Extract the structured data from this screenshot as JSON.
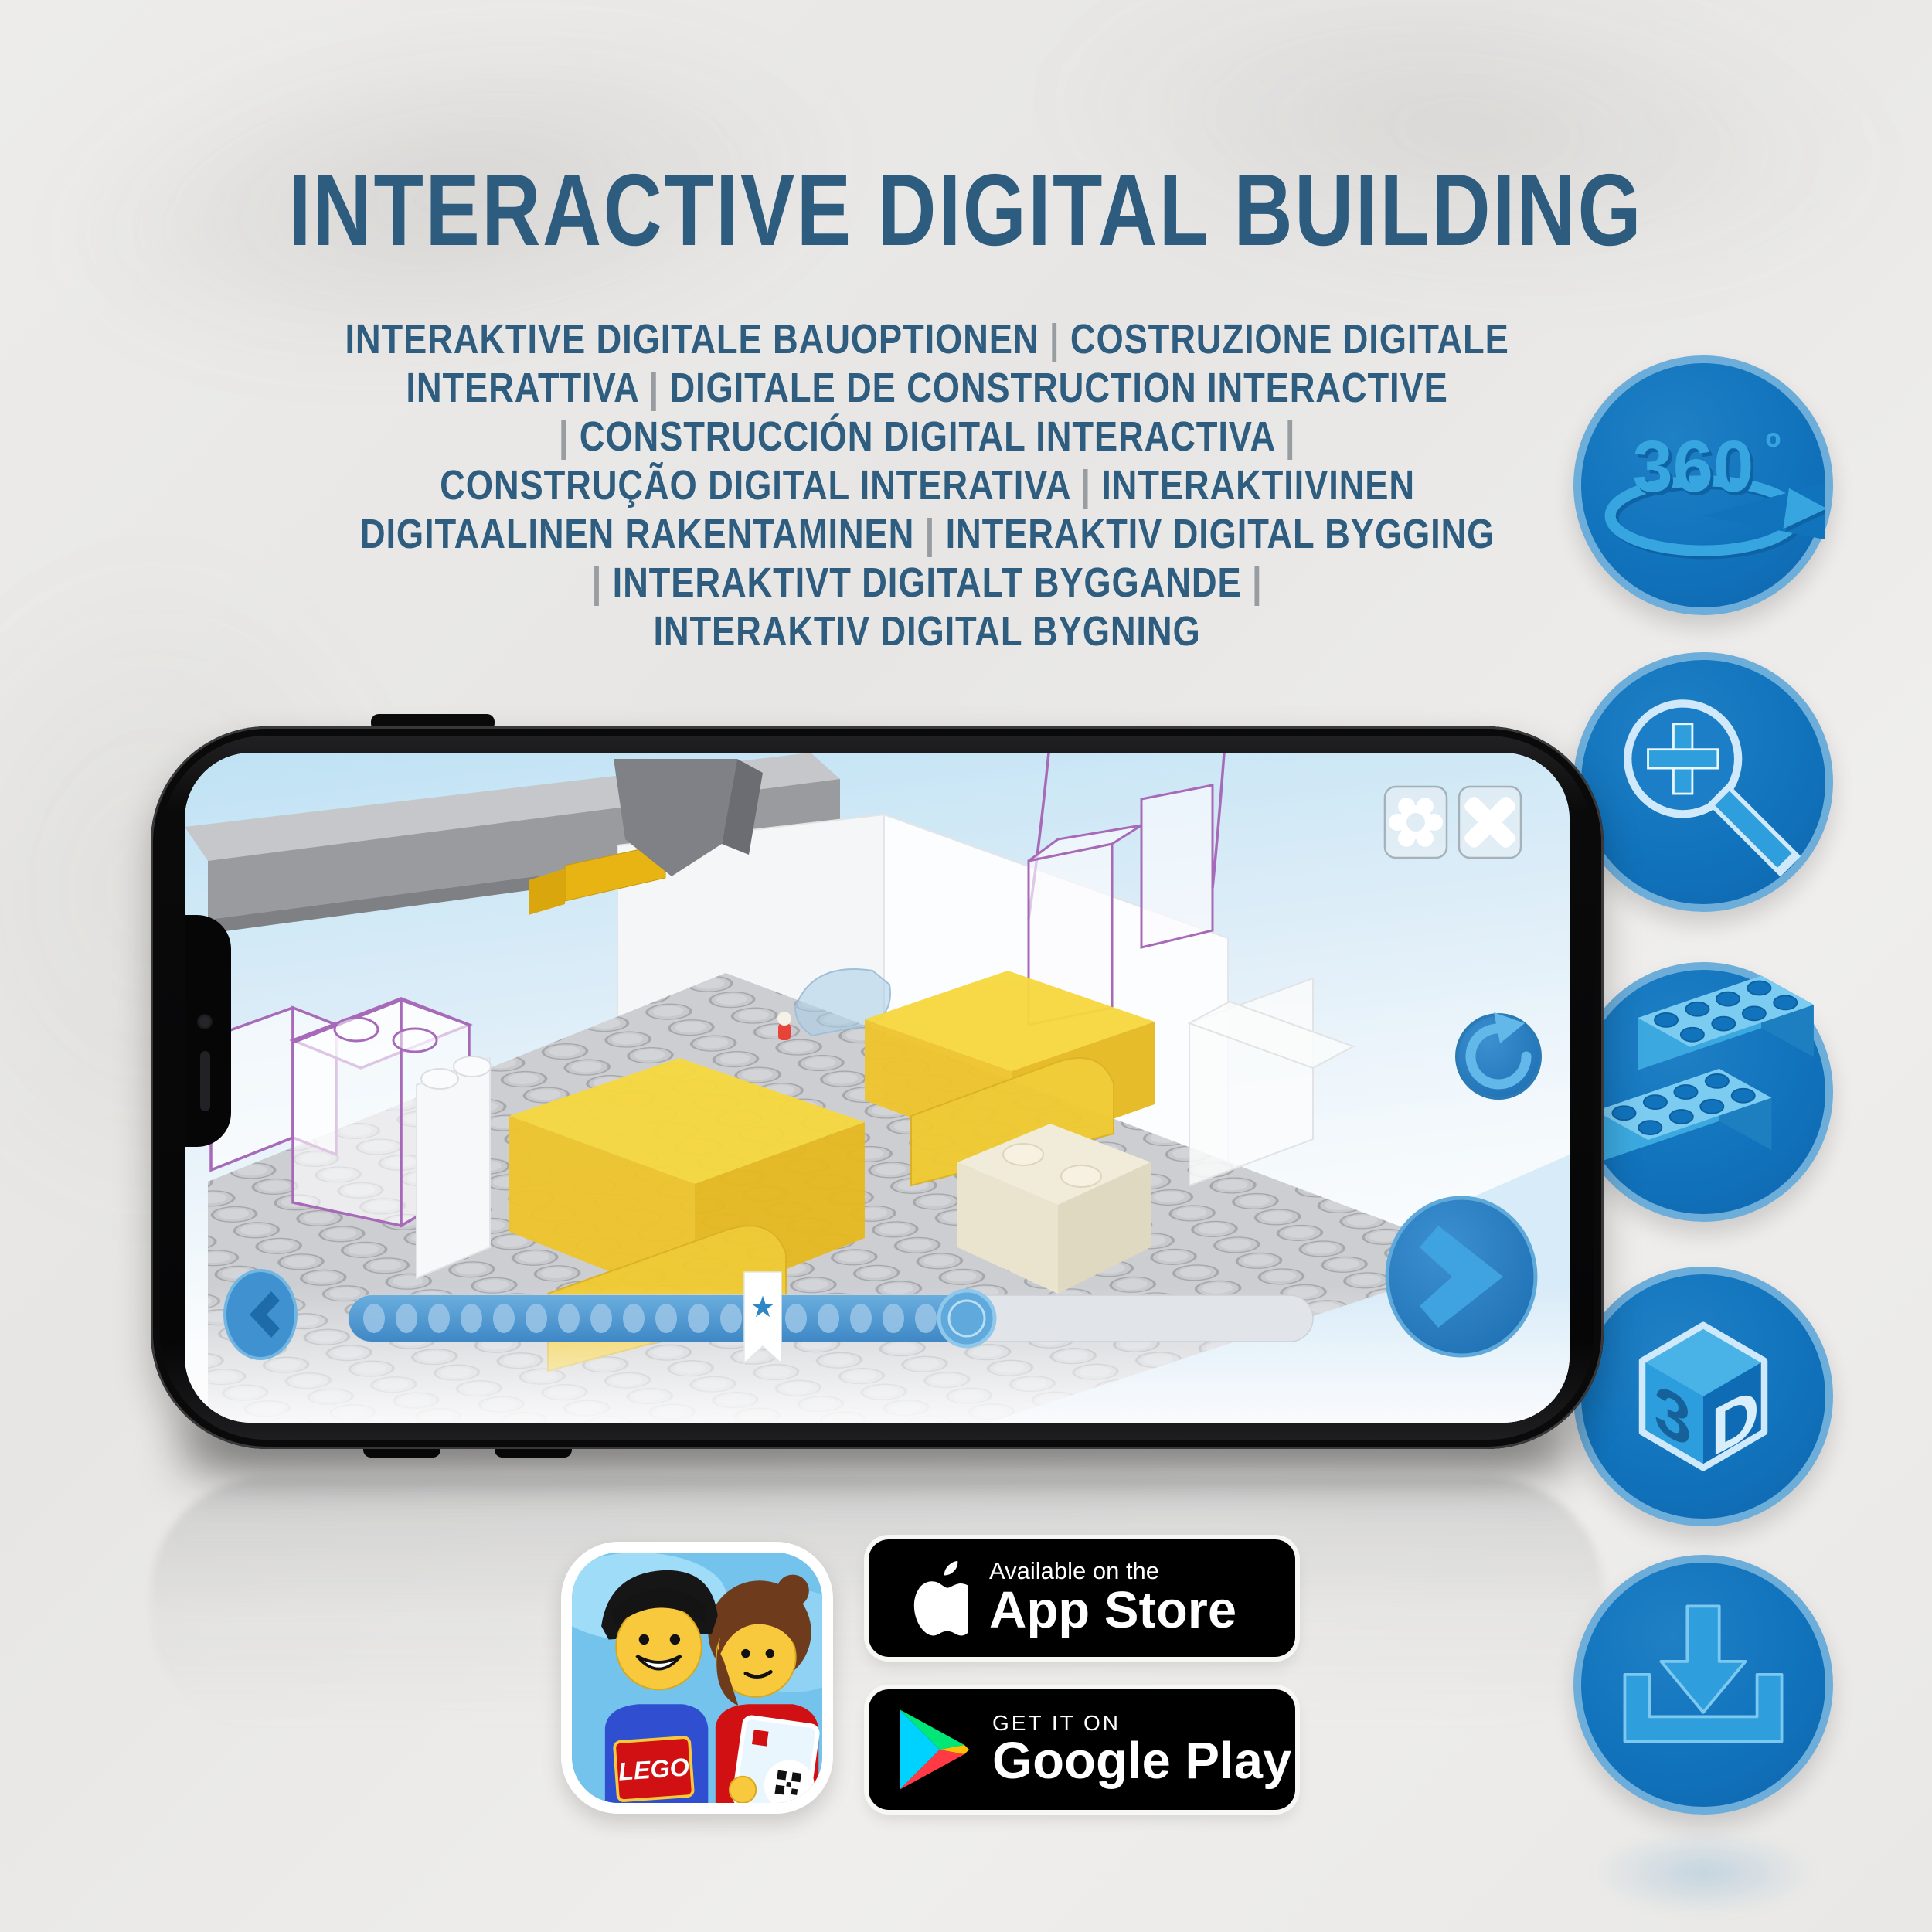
{
  "title": {
    "text": "INTERACTIVE DIGITAL BUILDING"
  },
  "subtitle": {
    "lines": [
      "INTERAKTIVE DIGITALE BAUOPTIONEN | COSTRUZIONE DIGITALE",
      "INTERATTIVA | DIGITALE DE CONSTRUCTION INTERACTIVE",
      "| CONSTRUCCIÓN DIGITAL INTERACTIVA |",
      "CONSTRUÇÃO DIGITAL INTERATIVA | INTERAKTIIVINEN",
      "DIGITAALINEN RAKENTAMINEN | INTERAKTIV DIGITAL BYGGING",
      "| INTERAKTIVT DIGITALT BYGGANDE |",
      "INTERAKTIV DIGITAL BYGNING"
    ]
  },
  "feature_icons": {
    "rotation_360": {
      "label": "360",
      "degree": "º"
    },
    "cube_3d": {
      "left_face": "3",
      "right_face": "D"
    },
    "glyph_names": [
      "360-rotation-icon",
      "zoom-in-icon",
      "brick-stack-icon",
      "3d-cube-icon",
      "download-icon"
    ]
  },
  "phone_app": {
    "progress": {
      "dots_total": 18,
      "bookmark_symbol": "★"
    },
    "control_icons": [
      "settings-gear",
      "close-x",
      "rotate-refresh",
      "previous-chevron",
      "next-chevron"
    ]
  },
  "store_badges": {
    "app_store": {
      "tagline": "Available on the",
      "name": "App Store"
    },
    "google_play": {
      "tagline": "GET IT ON",
      "name": "Google Play"
    }
  },
  "app_icon": {
    "brand": "LEGO"
  },
  "colors": {
    "title_blue": "#2d5c7e",
    "icon_circle_blue": "#1173bc",
    "icon_ring_blue": "#6cadda",
    "icon_glyph_blue": "#37a6e0",
    "screen_button_blue": "#2e86c9",
    "trans_yellow": "#f2cb30",
    "ghost_outline_purple": "#a76ab8",
    "badge_background": "#000000"
  }
}
